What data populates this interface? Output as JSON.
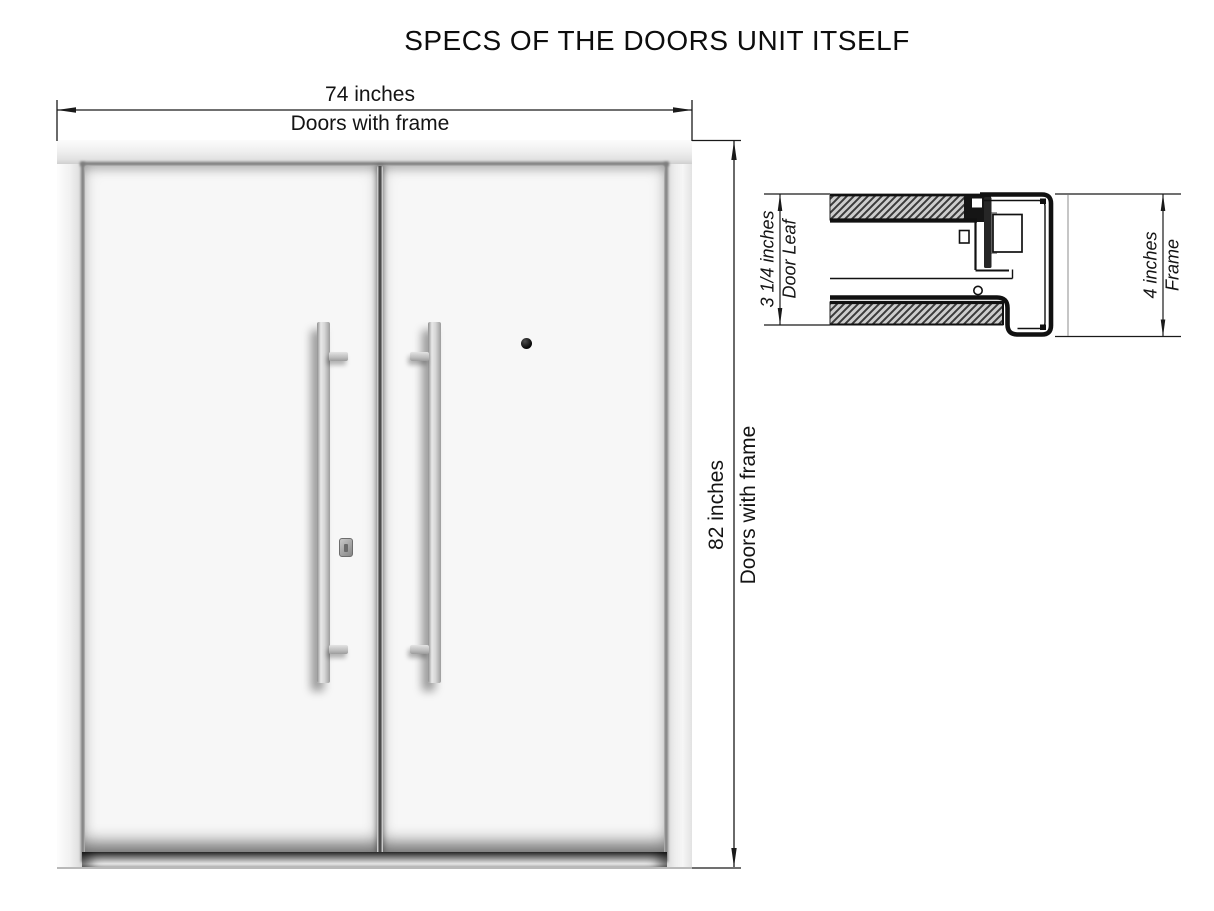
{
  "title": "SPECS OF THE DOORS UNIT ITSELF",
  "front_view": {
    "width_dimension": {
      "value": "74 inches",
      "label": "Doors with frame"
    },
    "height_dimension": {
      "value": "82 inches",
      "label": "Doors with frame"
    }
  },
  "section_view": {
    "door_leaf_dimension": {
      "value": "3 1/4 inches",
      "label": "Door Leaf"
    },
    "frame_dimension": {
      "value": "4 inches",
      "label": "Frame"
    }
  },
  "colors": {
    "line": "#1a1a1a",
    "frame_metal": "#ececec",
    "leaf_face": "#f7f7f7",
    "handle_metal": "#cfcfcf",
    "gap_shadow": "#474747",
    "hatch_fill": "#cdcdcd"
  }
}
